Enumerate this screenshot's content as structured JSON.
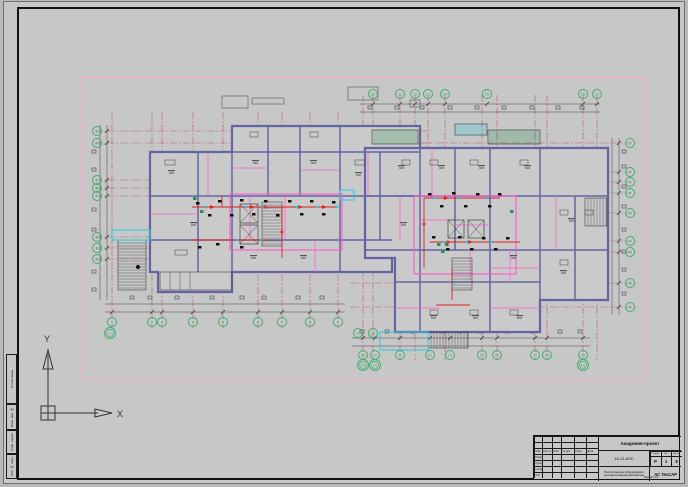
{
  "ucs": {
    "x": "X",
    "y": "Y"
  },
  "colors": {
    "border_pink": "#ffa3cf",
    "wall": "#6464a5",
    "partition": "#ff58cf",
    "grid_red": "#bb5a68",
    "route_red": "#dd2020",
    "cyan": "#28cbdc",
    "green_axis": "#3fae70",
    "device_black": "#111111",
    "hatch_green": "#2d8f57",
    "detail_gray": "#444444"
  },
  "axis_labels": {
    "bottom_left": [
      "1",
      "2",
      "3",
      "4",
      "5",
      "6",
      "7",
      "8",
      "9"
    ],
    "bottom_left_offset": [
      "1"
    ],
    "bottom_right": [
      "10",
      "11",
      "12",
      "13",
      "14",
      "15",
      "16",
      "17",
      "18",
      "19"
    ],
    "bottom_right_offset": [
      "10",
      "11",
      "19"
    ],
    "mid_pair": [
      "10",
      "11"
    ],
    "top_right": [
      "10",
      "11",
      "12",
      "13",
      "14",
      "15",
      "16",
      "17"
    ],
    "left_col": [
      "И",
      "Ж",
      "Е",
      "Д",
      "Г",
      "В",
      "Б",
      "А"
    ],
    "right_col": [
      "У",
      "Т",
      "С",
      "Р",
      "П",
      "Н",
      "М",
      "Л",
      "К"
    ]
  },
  "side_stamps": [
    "Согласовано",
    "Взам. инв. №",
    "Подп. и дата",
    "Инв. № подл."
  ],
  "title_block": {
    "project_name": "Академия-проект",
    "doc_code": "16-13-АПС",
    "doc_name": "Расположение оборудования противопожарной автоматики",
    "org_name": "АС ТехСАР",
    "stage_headers": [
      "Стадия",
      "Лист",
      "Листов"
    ],
    "stage_values": [
      "Р",
      "1",
      "8"
    ],
    "header_cols": [
      "Изм.",
      "Кол.уч",
      "Лист",
      "№ док.",
      "Подп.",
      "Дата"
    ],
    "sign_rows": [
      "Разраб.",
      "Пров.",
      "Н.контр.",
      "Утв."
    ],
    "format_label": "Формат А1"
  }
}
